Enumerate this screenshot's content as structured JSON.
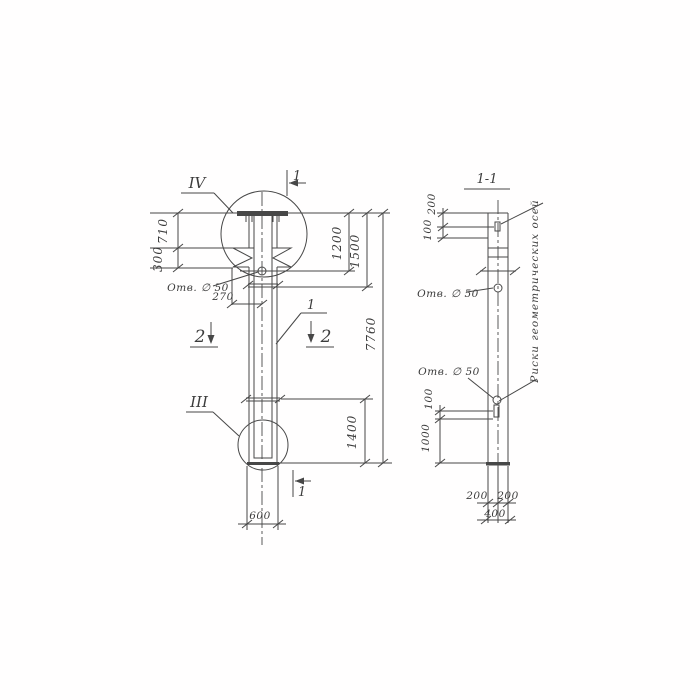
{
  "drawing": {
    "front": {
      "detail_top_label": "IV",
      "detail_bottom_label": "III",
      "element_mark": "1",
      "section1_label": "1",
      "section2_label": "2",
      "hole_label": "Отв. ∅ 50",
      "dims": {
        "d710": "710",
        "d300": "300",
        "d270": "270",
        "d1200": "1200",
        "d1500": "1500",
        "d7760": "7760",
        "d1400": "1400",
        "d600": "600"
      }
    },
    "section": {
      "title": "1-1",
      "hole_label": "Отв. ∅ 50",
      "axes_note": "Риски геометрических осей",
      "dims": {
        "d200_top": "200",
        "d100_top": "100",
        "d100_bot": "100",
        "d1000": "1000",
        "d200_left": "200",
        "d200_right": "200",
        "d400": "400"
      }
    },
    "colors": {
      "ink": "#474747",
      "paper": "#ffffff"
    }
  }
}
